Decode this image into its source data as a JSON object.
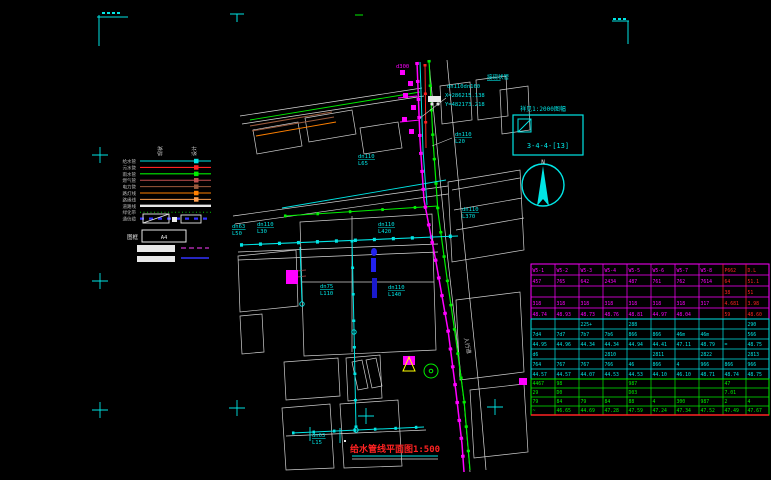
{
  "colors": {
    "background": "#000000",
    "cyan": "#00e5e5",
    "magenta": "#ff00ff",
    "green": "#00ee00",
    "red": "#ff2222",
    "white": "#e0e0e0",
    "blue": "#2222ee",
    "orange": "#ff8000",
    "brown": "#9c5a3c",
    "yellow": "#ffff00"
  },
  "title": {
    "text": "给水管线平面图1:500"
  },
  "north": {
    "label": "N"
  },
  "index_box": {
    "caption": "祥见1:2000图幅",
    "code": "3-4-4-[13]"
  },
  "legend": {
    "col_headers": [
      "现状",
      "设计"
    ],
    "frame_label": "图框",
    "frame_value": "A4",
    "items": [
      {
        "label": "给水管",
        "color": "#00e5e5",
        "w": 1.1
      },
      {
        "label": "污水管",
        "color": "#ff2222",
        "w": 1.1
      },
      {
        "label": "雨水管",
        "color": "#00ee00",
        "w": 1.1
      },
      {
        "label": "燃气管",
        "color": "#c05050",
        "w": 1
      },
      {
        "label": "电力管",
        "color": "#9c5a3c",
        "w": 1
      },
      {
        "label": "路灯线",
        "color": "#ff8000",
        "w": 1
      },
      {
        "label": "路缘线",
        "color": "#ff9f50",
        "w": 1
      },
      {
        "label": "道路线",
        "color": "#e8e8e8",
        "w": 2.4,
        "glyph": false
      },
      {
        "label": "绿化带",
        "color": "#00c000",
        "w": 1,
        "dash": "1 2.5",
        "glyph": false
      },
      {
        "label": "通信缆",
        "color": "#3333ff",
        "w": 2.2,
        "dash": "4 5",
        "glyph": false
      }
    ]
  },
  "annotations": [
    {
      "x": 487,
      "y": 79,
      "lines": [
        "接现状管"
      ],
      "color": "#00e5e5",
      "ul": true
    },
    {
      "x": 447,
      "y": 88,
      "lines": [
        "dn110dn160"
      ],
      "color": "#00e5e5"
    },
    {
      "x": 445,
      "y": 97,
      "lines": [
        "X=286215.138"
      ],
      "color": "#00e5e5"
    },
    {
      "x": 445,
      "y": 106,
      "lines": [
        "Y=482173.218"
      ],
      "color": "#00e5e5"
    },
    {
      "x": 455,
      "y": 136,
      "lines": [
        "dn110",
        "L20"
      ],
      "color": "#00e5e5",
      "ul": true
    },
    {
      "x": 358,
      "y": 158,
      "lines": [
        "dn110",
        "L65"
      ],
      "color": "#00e5e5",
      "ul": true
    },
    {
      "x": 232,
      "y": 228,
      "lines": [
        "dn63",
        "L50"
      ],
      "color": "#00e5e5",
      "ul": true
    },
    {
      "x": 257,
      "y": 226,
      "lines": [
        "dn110",
        "L30"
      ],
      "color": "#00e5e5",
      "ul": true
    },
    {
      "x": 462,
      "y": 211,
      "lines": [
        "dn110",
        "L370"
      ],
      "color": "#00e5e5",
      "ul": true
    },
    {
      "x": 378,
      "y": 226,
      "lines": [
        "dn110",
        "L420"
      ],
      "color": "#00e5e5",
      "ul": true
    },
    {
      "x": 320,
      "y": 288,
      "lines": [
        "dn75",
        "L110"
      ],
      "color": "#00e5e5",
      "ul": true
    },
    {
      "x": 388,
      "y": 289,
      "lines": [
        "dn110",
        "L140"
      ],
      "color": "#00e5e5",
      "ul": true
    },
    {
      "x": 312,
      "y": 437,
      "lines": [
        "dn63",
        "L15"
      ],
      "color": "#00e5e5",
      "ul": true
    },
    {
      "x": 396,
      "y": 68,
      "lines": [
        "d300"
      ],
      "color": "#ff00ff"
    },
    {
      "x": 464,
      "y": 338,
      "lines": [
        "人行道"
      ],
      "color": "#cccccc",
      "rot": 78
    }
  ],
  "table": {
    "x": 531,
    "y": 264,
    "w": 238,
    "col_widths": [
      24,
      24,
      24,
      24,
      24,
      24,
      24,
      24,
      23,
      23
    ],
    "bottom_border": "#ff2222",
    "bands": [
      {
        "color": "#ff00ff",
        "accent": "#ff2222",
        "accent_cols": [
          8,
          9
        ],
        "row_h": 11,
        "rows": [
          [
            "W5-1",
            "W5-2",
            "W5-3",
            "W5-4",
            "W5-5",
            "W5-6",
            "W5-7",
            "W5-8",
            "P662",
            "D.L"
          ],
          [
            "457",
            "765",
            "642",
            "2434",
            "487",
            "761",
            "762",
            "7614",
            "64",
            "51.1"
          ],
          [
            "",
            "",
            "",
            "",
            "",
            "",
            "",
            "",
            "38",
            "51"
          ],
          [
            "318",
            "318",
            "318",
            "318",
            "318",
            "318",
            "318",
            "317",
            "4.681",
            "3.98"
          ],
          [
            "48.74",
            "48.93",
            "48.73",
            "48.76",
            "48.81",
            "44.97",
            "48.04",
            "",
            "59",
            "48.60"
          ]
        ]
      },
      {
        "color": "#00e5e5",
        "row_h": 10,
        "rows": [
          [
            "",
            "",
            "225+",
            "",
            "288",
            "",
            "",
            "",
            "",
            "290"
          ],
          [
            "7d4",
            "7d7",
            "7b7",
            "7b6",
            "866",
            "866",
            "46m",
            "46m",
            "",
            "566"
          ],
          [
            "44.95",
            "44.96",
            "44.34",
            "44.34",
            "44.94",
            "44.41",
            "47.11",
            "48.79",
            "=",
            "48.75"
          ],
          [
            "d6",
            "",
            "",
            "2810",
            "",
            "2811",
            "",
            "2822",
            "",
            "2813"
          ],
          [
            "764",
            "767",
            "767",
            "766",
            "46",
            "866",
            "4",
            "966",
            "866",
            "966"
          ],
          [
            "44.57",
            "44.57",
            "44.07",
            "44.53",
            "44.53",
            "44.10",
            "46.10",
            "48.71",
            "48.74",
            "48.75"
          ]
        ]
      },
      {
        "color": "#00ee00",
        "row_h": 9,
        "rows": [
          [
            "4467",
            "98",
            "",
            "",
            "987",
            "",
            "",
            "",
            "47",
            ""
          ],
          [
            "29",
            "D0",
            "",
            "",
            "D03",
            "",
            "",
            "",
            "7.01",
            ""
          ],
          [
            "79",
            "84",
            "79",
            "84",
            "88",
            "4",
            "300",
            "987",
            "2",
            "4"
          ],
          [
            "~",
            "46.65",
            "44.69",
            "47.28",
            "47.59",
            "47.24",
            "47.34",
            "47.52",
            "47.49",
            "47.67"
          ]
        ]
      }
    ]
  }
}
